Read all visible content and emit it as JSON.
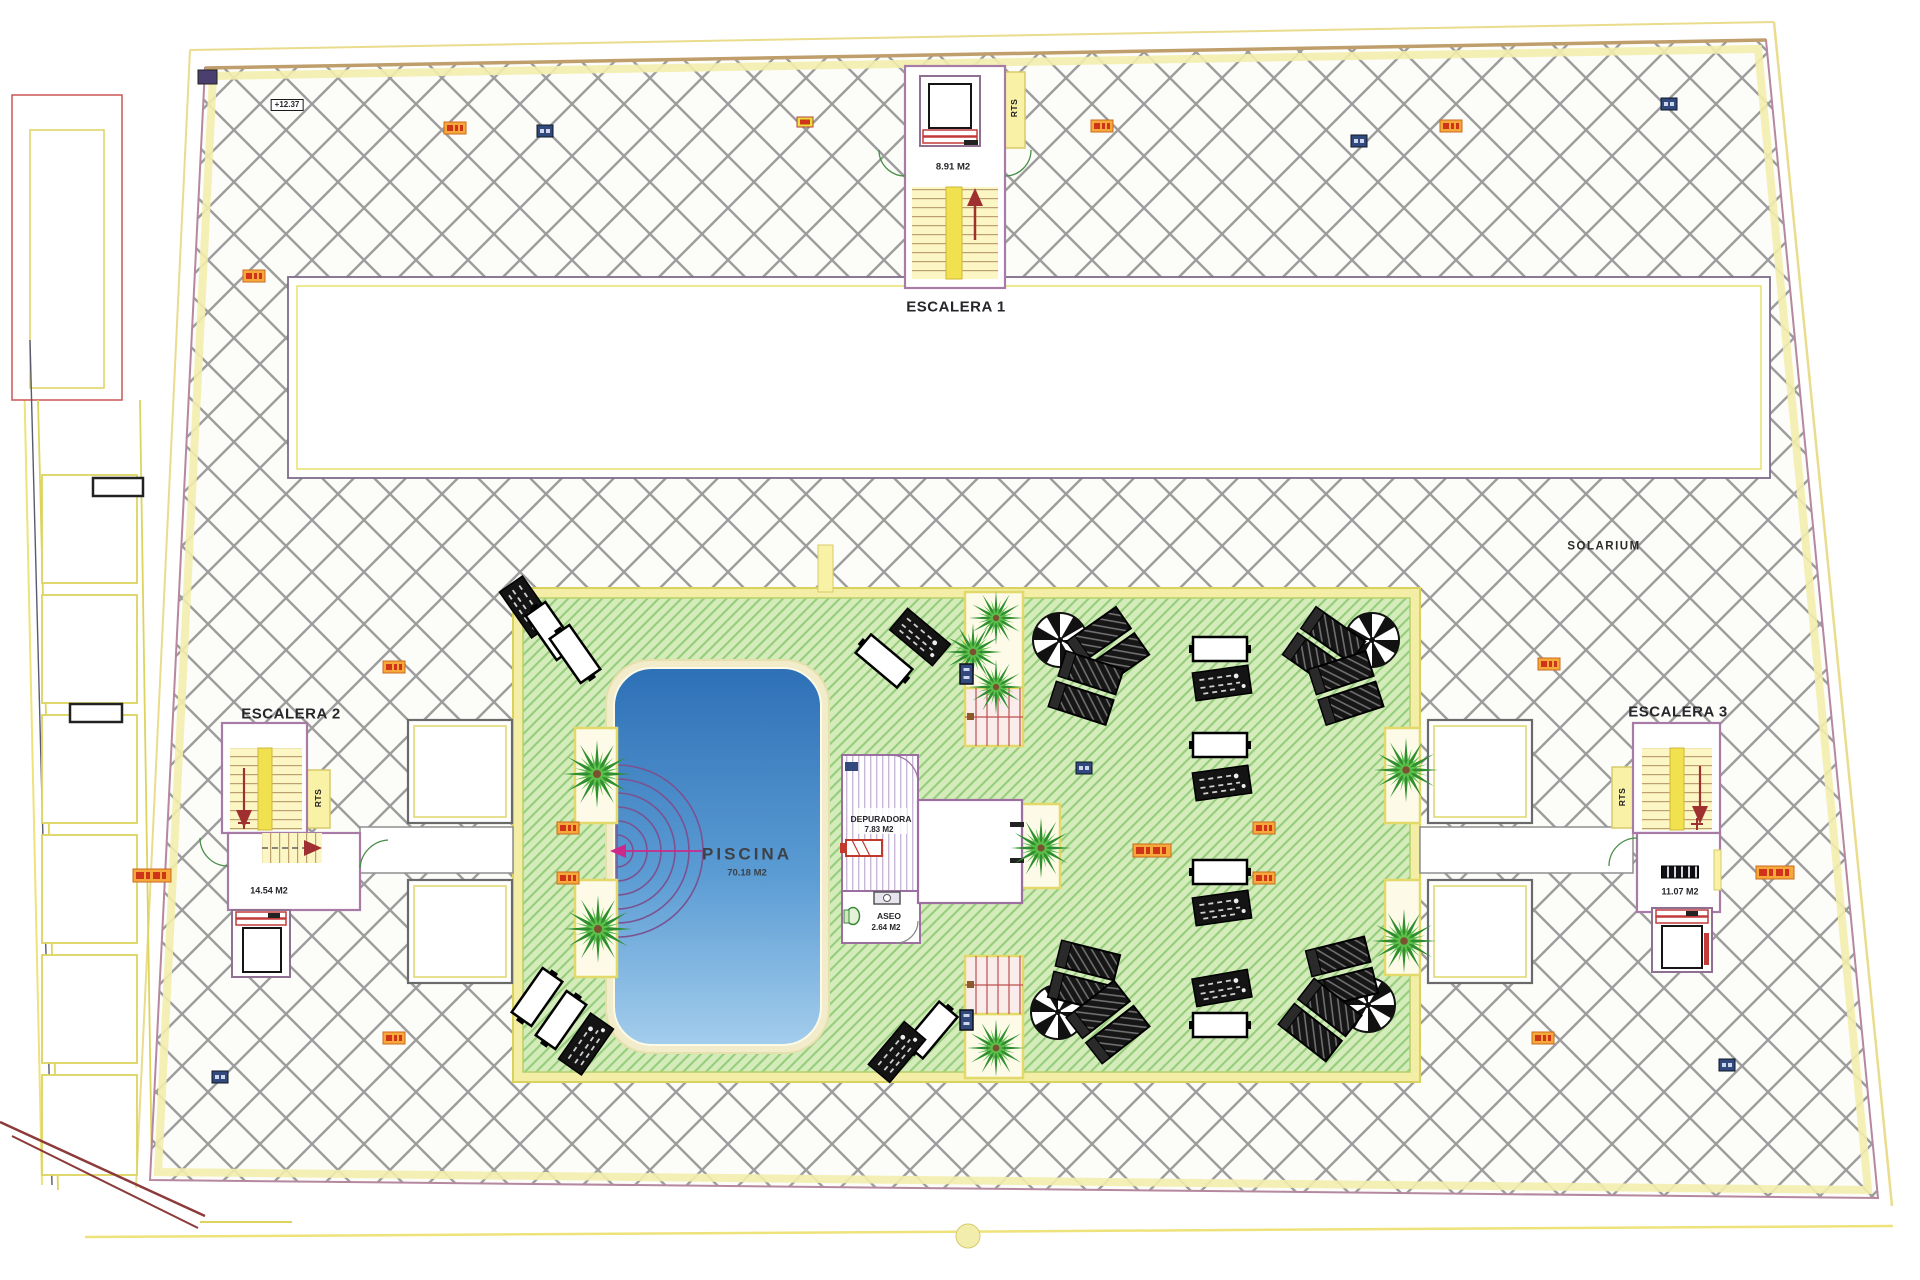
{
  "plan": {
    "labels": {
      "escalera1": "ESCALERA 1",
      "escalera1_area": "8.91 M2",
      "escalera2": "ESCALERA 2",
      "escalera2_area": "14.54 M2",
      "escalera3": "ESCALERA 3",
      "escalera3_area": "11.07 M2",
      "rts": "RTS",
      "solarium": "SOLARIUM",
      "piscina": "PISCINA",
      "piscina_area": "70.18 M2",
      "depuradora": "DEPURADORA",
      "depuradora_area": "7.83 M2",
      "aseo": "ASEO",
      "aseo_area": "2.64 M2",
      "level_marker": "+12.37"
    },
    "colors": {
      "terrace_hatch_line": "#9d9d9d",
      "lawn_green": "#d4ecba",
      "lawn_stripe": "#96cd7d",
      "pool_water_top": "#2e70b6",
      "pool_water_bottom": "#a3cdec",
      "pool_rim": "#f2ecca",
      "boundary_yellow": "#efe9a6",
      "wall_purple": "#a77ba5",
      "stair_yellow": "#f5e97f",
      "arrow_red": "#a03030",
      "tag_orange": "#f6a83b",
      "tag_blue": "#31497c",
      "palm_green": "#2f8f2f"
    }
  }
}
